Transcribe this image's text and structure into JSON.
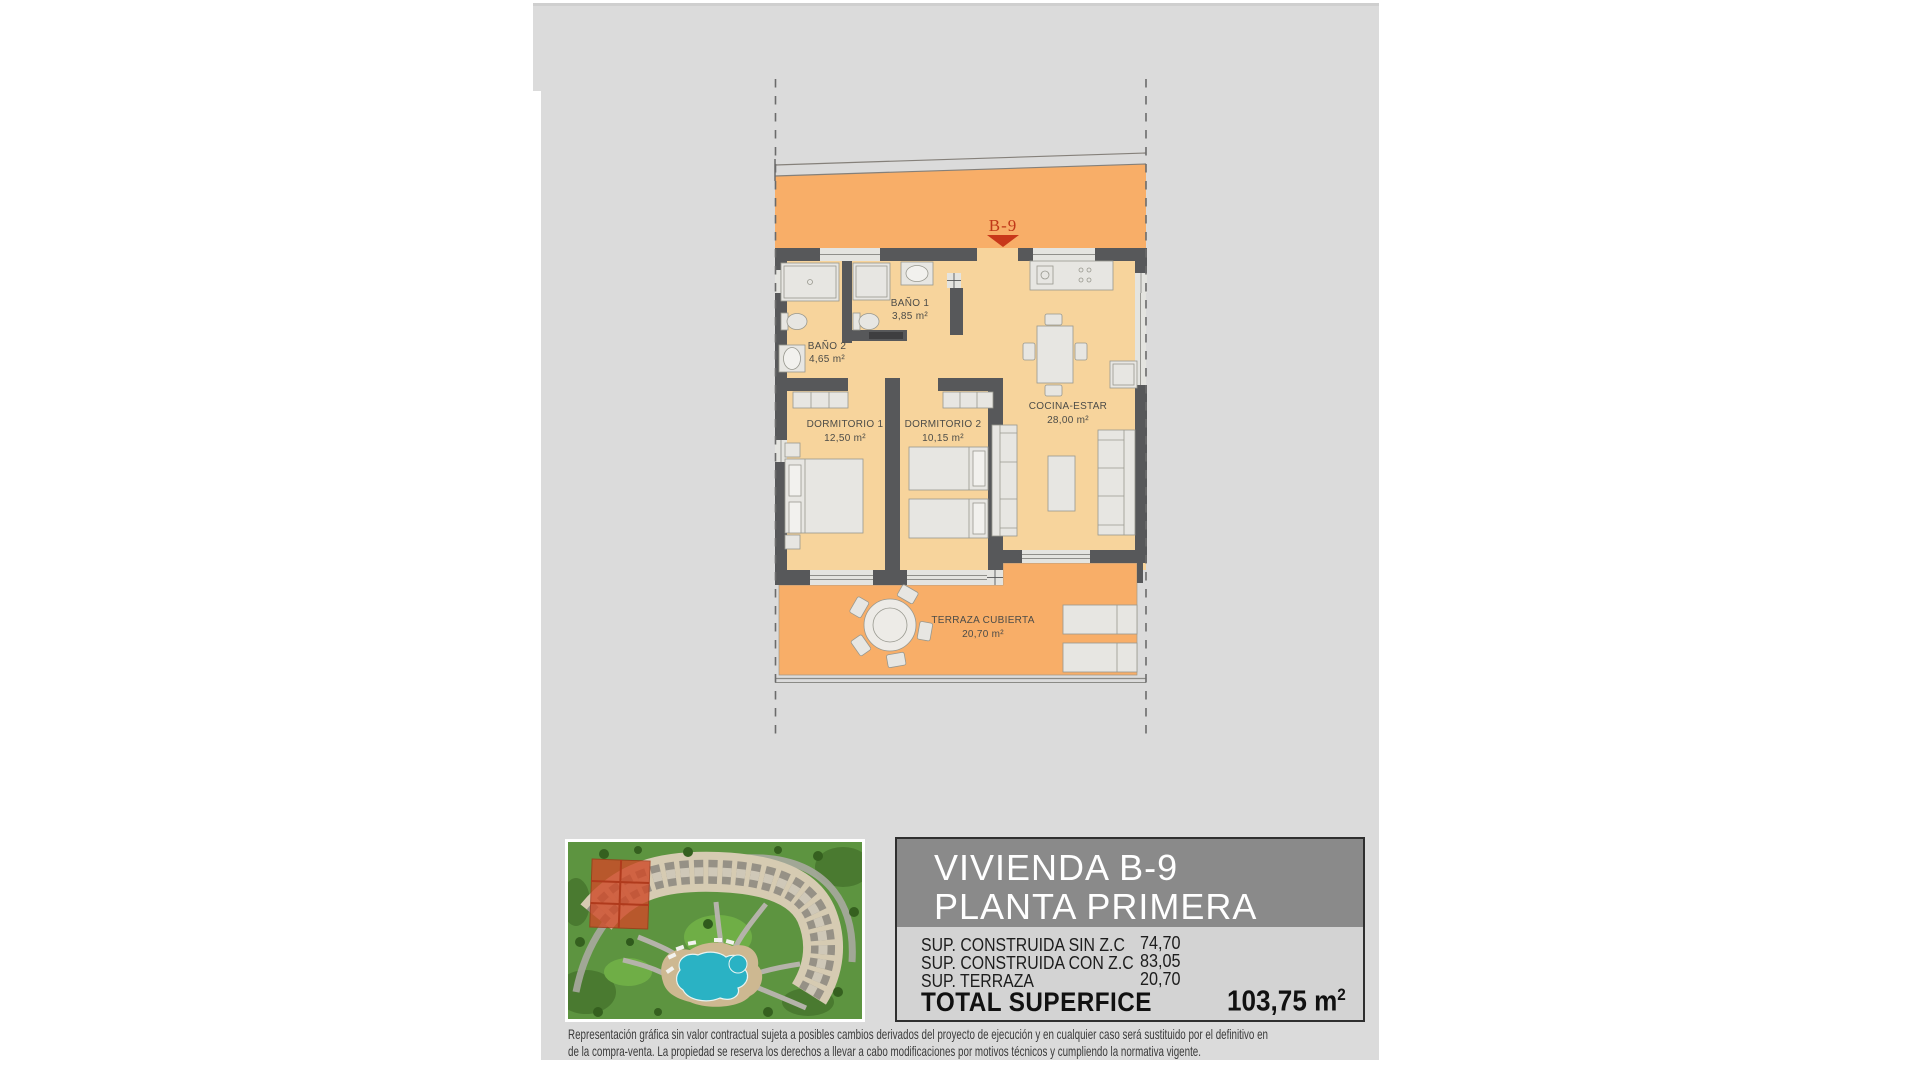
{
  "plan": {
    "unit_label": "B-9",
    "rooms": {
      "bano1": {
        "name": "BAÑO 1",
        "area": "3,85 m²"
      },
      "bano2": {
        "name": "BAÑO 2",
        "area": "4,65 m²"
      },
      "dorm1": {
        "name": "DORMITORIO 1",
        "area": "12,50 m²"
      },
      "dorm2": {
        "name": "DORMITORIO 2",
        "area": "10,15 m²"
      },
      "cocina": {
        "name": "COCINA-ESTAR",
        "area": "28,00 m²"
      },
      "terraza": {
        "name": "TERRAZA CUBIERTA",
        "area": "20,70 m²"
      }
    }
  },
  "title_block": {
    "title_line1": "VIVIENDA B-9",
    "title_line2": "PLANTA PRIMERA",
    "rows": [
      {
        "label": "SUP. CONSTRUIDA SIN Z.C",
        "value": "74,70"
      },
      {
        "label": "SUP. CONSTRUIDA CON Z.C",
        "value": "83,05"
      },
      {
        "label": "SUP. TERRAZA",
        "value": "20,70"
      }
    ],
    "total_label": "TOTAL SUPERFICE",
    "total_value": "103,75 m",
    "total_value_sup": "2"
  },
  "disclaimer": {
    "line1": "Representación gráfica sin valor contractual sujeta a posibles cambios derivados del proyecto de ejecución y en cualquier caso será sustituido por el definitivo en",
    "line2": "de la compra-venta. La propiedad se reserva los derechos a llevar a cabo modificaciones por motivos técnicos y cumpliendo la normativa vigente."
  },
  "colors": {
    "panel_gray": "#DBDBDB",
    "corridor_orange": "#F8AE68",
    "room_cream": "#F7D49C",
    "wall_dark": "#57585A",
    "unit_label_red": "#C03818",
    "header_gray": "#8A8A8A",
    "pool_cyan": "#2AB2C4",
    "highlight_red": "#CF4A28"
  }
}
